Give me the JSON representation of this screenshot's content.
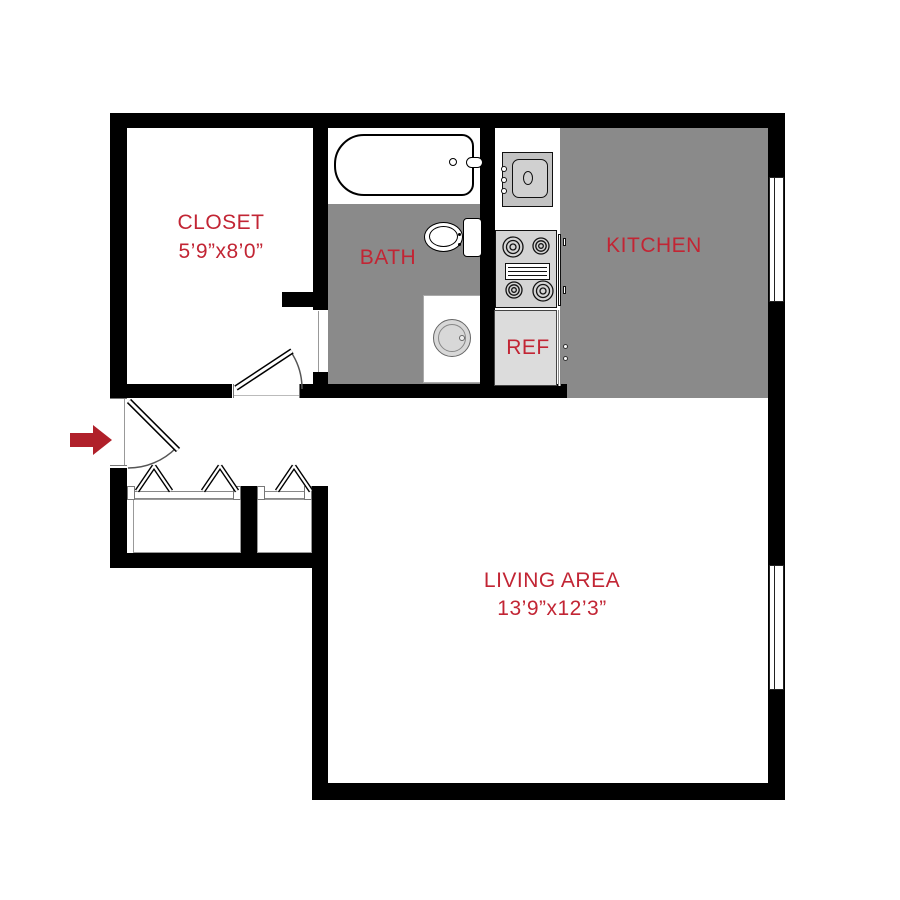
{
  "colors": {
    "wall": "#000000",
    "room_floor_gray": "#8A8A8A",
    "label_red": "#C22534",
    "arrow_red": "#B0202A"
  },
  "rooms": {
    "closet": {
      "label": "CLOSET",
      "dims": "5’9”x8’0”"
    },
    "bath": {
      "label": "BATH"
    },
    "kitchen": {
      "label": "KITCHEN"
    },
    "ref": {
      "label": "REF"
    },
    "living": {
      "label": "LIVING AREA",
      "dims": "13’9”x12’3”"
    }
  },
  "fixtures": {
    "bathtub": "bathtub",
    "toilet": "toilet",
    "washer": "washer",
    "kitchen_sink": "kitchen sink",
    "stove": "stove",
    "refrigerator": "refrigerator"
  },
  "entry": {
    "direction": "right"
  }
}
